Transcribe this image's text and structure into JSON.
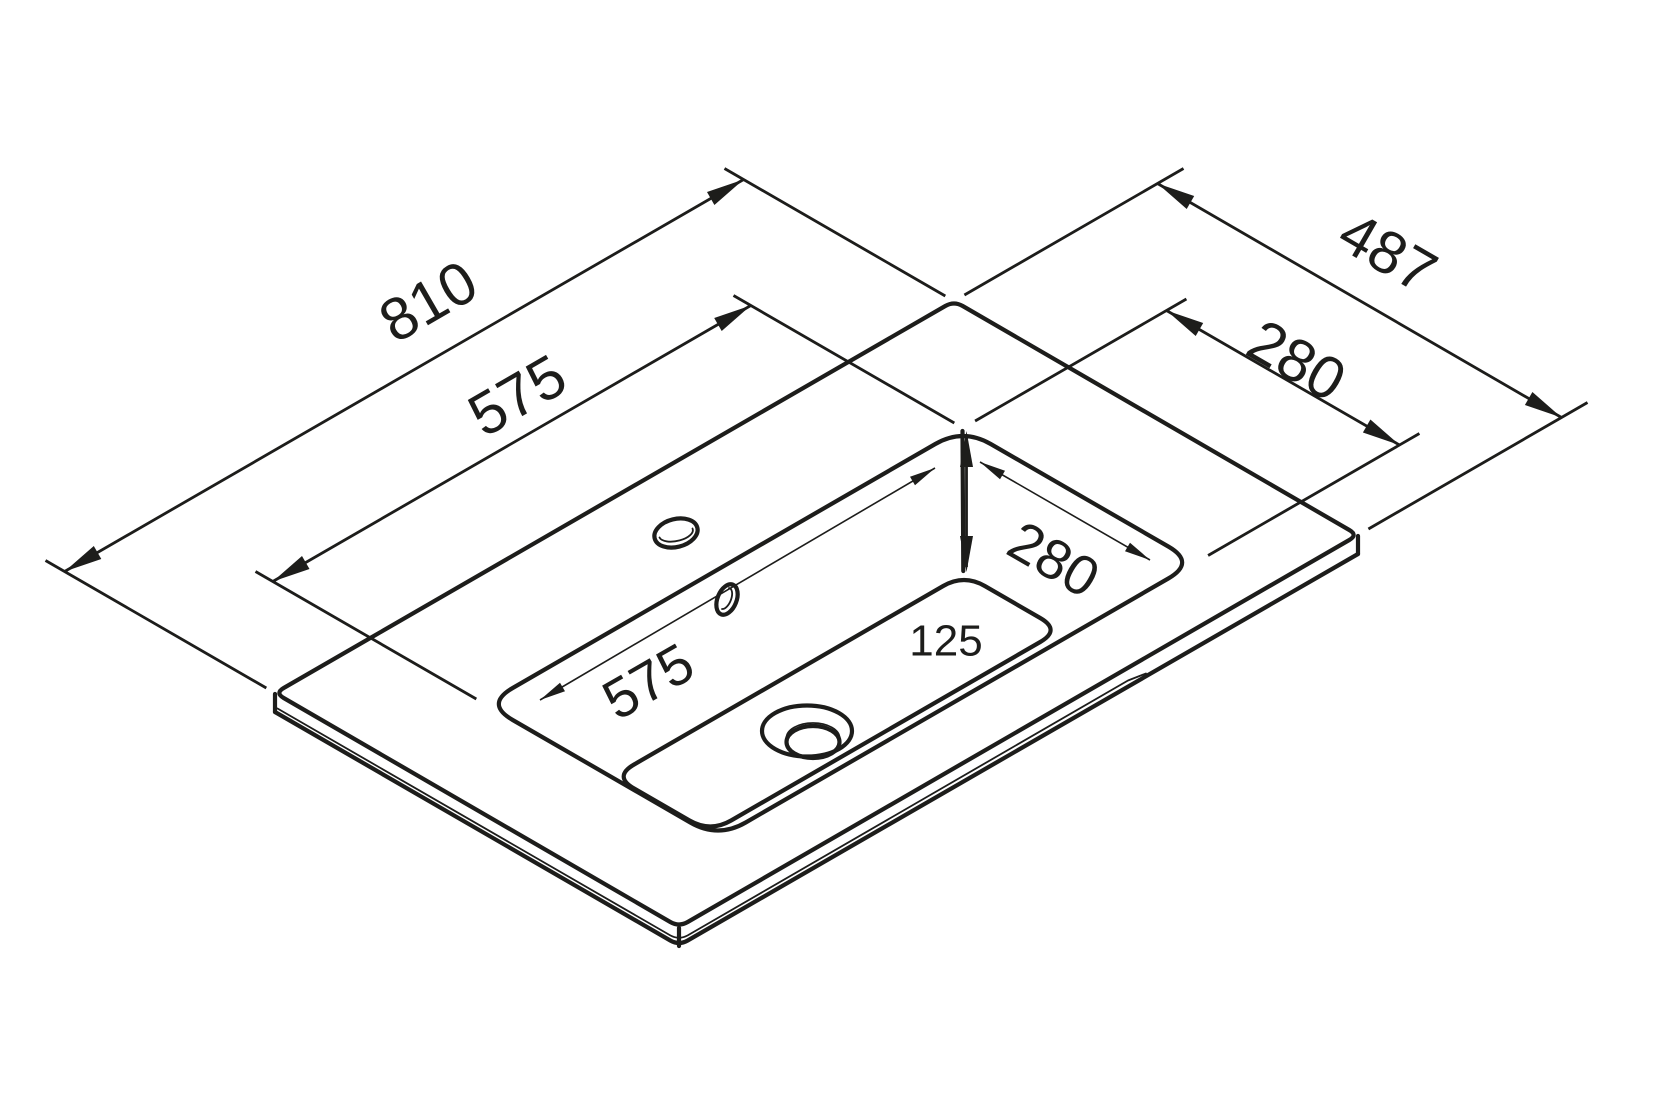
{
  "drawing": {
    "type": "isometric-technical-drawing",
    "subject": "washbasin vanity countertop with integrated basin",
    "background": "#ffffff",
    "line_color": "#1d1d1b",
    "labels": {
      "countertop_width": "810",
      "basin_width_outer": "575",
      "countertop_depth": "487",
      "basin_depth_outer": "280",
      "basin_width_inner": "575",
      "basin_depth_inner": "280",
      "basin_depth_vertical": "125"
    }
  }
}
